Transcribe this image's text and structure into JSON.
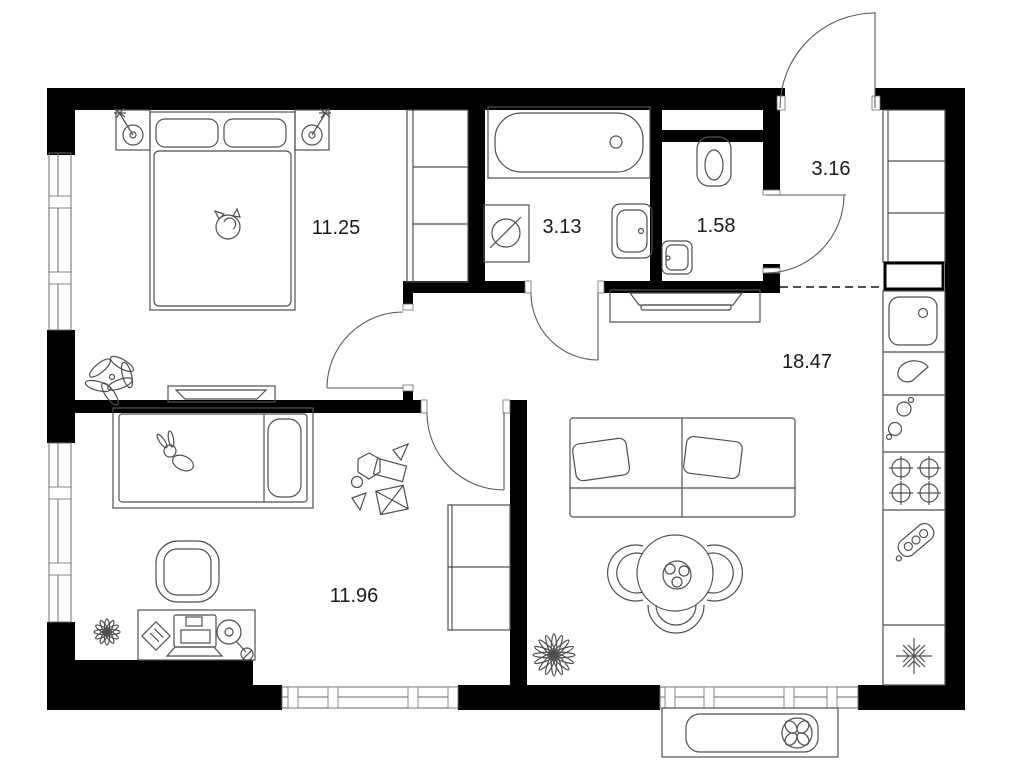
{
  "page": {
    "background": "#ffffff",
    "type": "apartment-floor-plan"
  },
  "colors": {
    "wall": "#000000",
    "furniture_line": "#4f4f4f",
    "label_text": "#1a1a1a"
  },
  "rooms": {
    "bedroom": {
      "name": "bedroom",
      "area_label": "11.25"
    },
    "bathroom": {
      "name": "bathroom",
      "area_label": "3.13"
    },
    "toilet": {
      "name": "toilet",
      "area_label": "1.58"
    },
    "hallway": {
      "name": "entrance-hallway",
      "area_label": "3.16"
    },
    "living_kitchen": {
      "name": "kitchen-living-room",
      "area_label": "18.47"
    },
    "kids_room": {
      "name": "kids-room",
      "area_label": "11.96"
    }
  },
  "icons": {
    "bedroom": [
      "double-bed",
      "pillow",
      "sleeping-cat",
      "nightstand",
      "table-lamp",
      "wardrobe",
      "dresser",
      "plant"
    ],
    "bathroom": [
      "bathtub",
      "washing-machine",
      "wash-basin"
    ],
    "toilet": [
      "toilet",
      "small-basin"
    ],
    "hallway": [
      "entrance-door",
      "closet-shelves",
      "duct-shaft"
    ],
    "living_kitchen": [
      "tv-console",
      "tv",
      "sofa",
      "pillows",
      "dining-table",
      "fruit-bowl",
      "chair",
      "plant",
      "kitchen-sink",
      "drainer",
      "fittings",
      "cooktop-4-burners",
      "small-appliance",
      "fridge-snowflake"
    ],
    "kids_room": [
      "single-bed",
      "bunny-toy",
      "toy-blocks",
      "armchair",
      "desk",
      "laptop",
      "notepad",
      "desk-lamp",
      "plant",
      "tall-cabinet"
    ],
    "exterior": [
      "window",
      "ac-unit-fan"
    ]
  }
}
